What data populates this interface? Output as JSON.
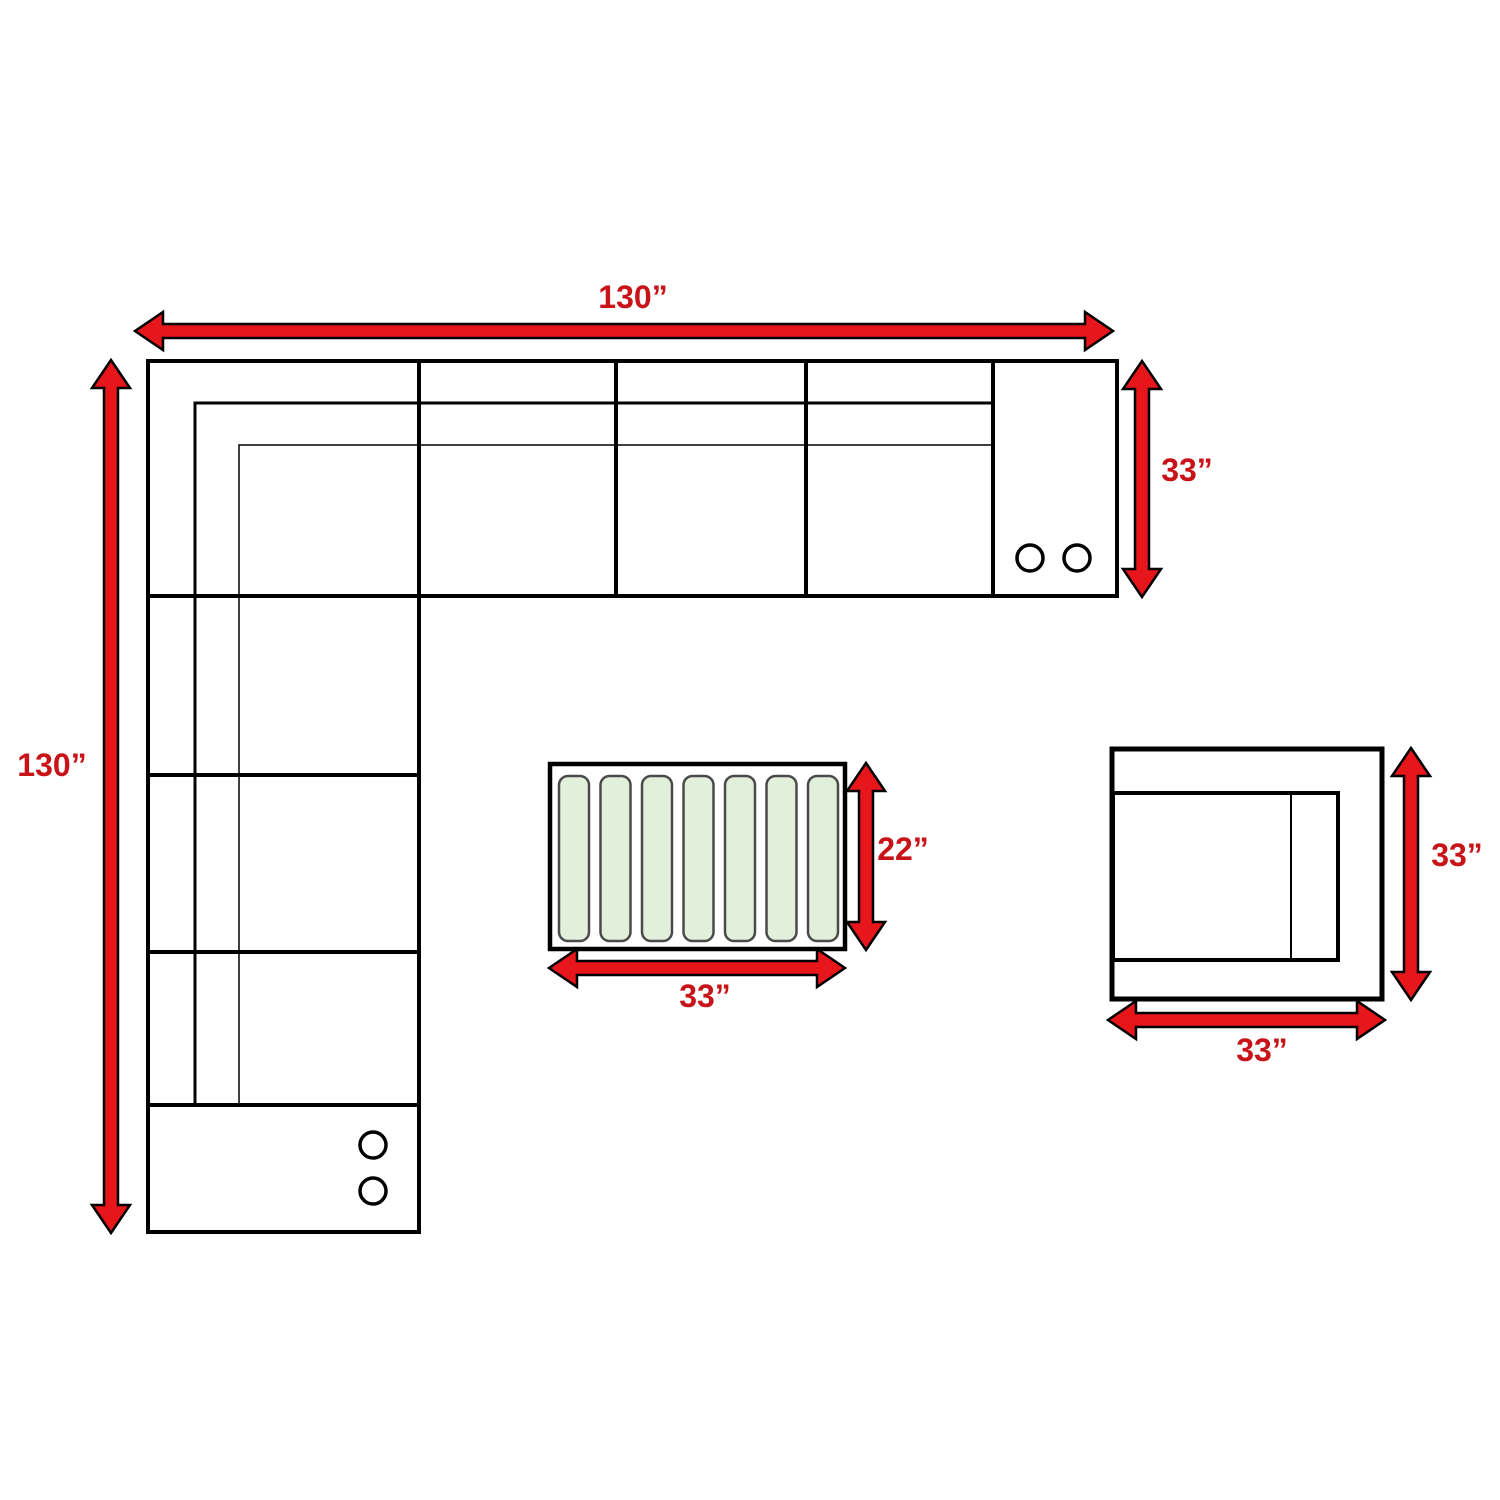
{
  "dimensions": {
    "sectional_total_width": "130”",
    "sectional_total_depth": "130”",
    "sofa_section_depth": "33”",
    "table_depth": "22”",
    "table_width": "33”",
    "chair_depth": "33”",
    "chair_width": "33”"
  },
  "colors": {
    "background": "#ffffff",
    "furniture_outline": "#000000",
    "arrow_fill": "#e7161b",
    "arrow_outline": "#000000",
    "label_text": "#c81419",
    "slat_fill": "#e2efda",
    "slat_border": "#4a4a4a"
  }
}
